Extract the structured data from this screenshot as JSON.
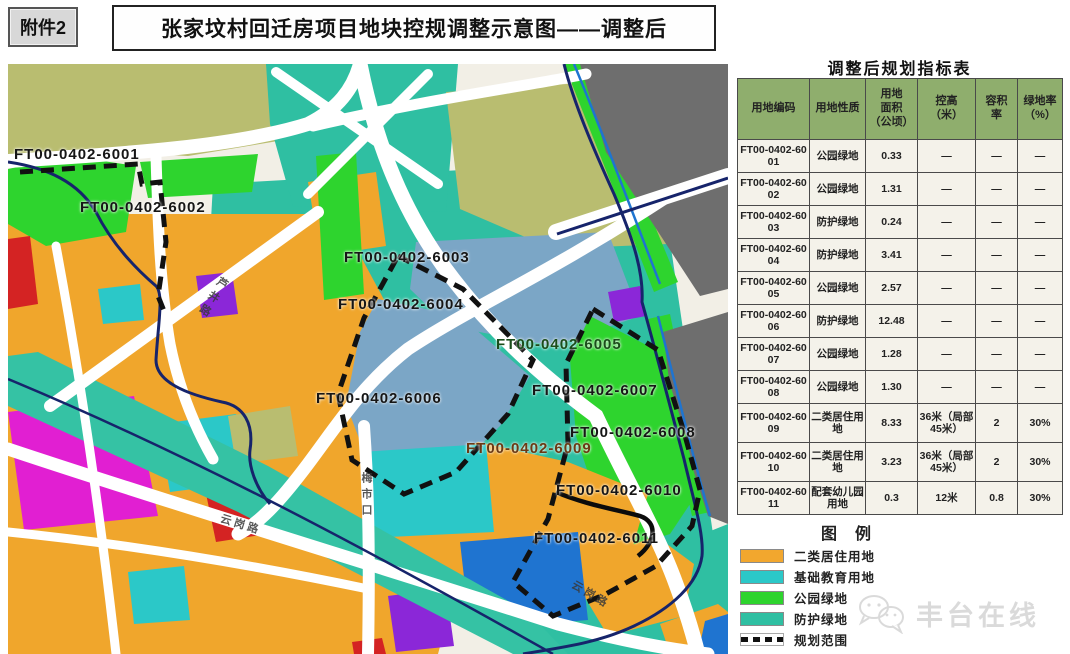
{
  "header": {
    "attachment_label": "附件2",
    "title": "张家坟村回迁房项目地块控规调整示意图——调整后"
  },
  "table": {
    "title": "调整后规划指标表",
    "columns": [
      "用地编码",
      "用地性质",
      "用地\n面积\n（公顷）",
      "控高\n（米）",
      "容积\n率",
      "绿地率\n（%）"
    ],
    "rows": [
      {
        "code": "FT00-0402-6001",
        "use": "公园绿地",
        "area": "0.33",
        "height": "—",
        "far": "—",
        "green": "—"
      },
      {
        "code": "FT00-0402-6002",
        "use": "公园绿地",
        "area": "1.31",
        "height": "—",
        "far": "—",
        "green": "—"
      },
      {
        "code": "FT00-0402-6003",
        "use": "防护绿地",
        "area": "0.24",
        "height": "—",
        "far": "—",
        "green": "—"
      },
      {
        "code": "FT00-0402-6004",
        "use": "防护绿地",
        "area": "3.41",
        "height": "—",
        "far": "—",
        "green": "—"
      },
      {
        "code": "FT00-0402-6005",
        "use": "公园绿地",
        "area": "2.57",
        "height": "—",
        "far": "—",
        "green": "—"
      },
      {
        "code": "FT00-0402-6006",
        "use": "防护绿地",
        "area": "12.48",
        "height": "—",
        "far": "—",
        "green": "—"
      },
      {
        "code": "FT00-0402-6007",
        "use": "公园绿地",
        "area": "1.28",
        "height": "—",
        "far": "—",
        "green": "—"
      },
      {
        "code": "FT00-0402-6008",
        "use": "公园绿地",
        "area": "1.30",
        "height": "—",
        "far": "—",
        "green": "—"
      },
      {
        "code": "FT00-0402-6009",
        "use": "二类居住用地",
        "area": "8.33",
        "height": "36米（局部45米）",
        "far": "2",
        "green": "30%"
      },
      {
        "code": "FT00-0402-6010",
        "use": "二类居住用地",
        "area": "3.23",
        "height": "36米（局部45米）",
        "far": "2",
        "green": "30%"
      },
      {
        "code": "FT00-0402-6011",
        "use": "配套幼儿园用地",
        "area": "0.3",
        "height": "12米",
        "far": "0.8",
        "green": "30%"
      }
    ]
  },
  "legend": {
    "title": "图例",
    "items": [
      {
        "label": "二类居住用地",
        "type": "swatch",
        "color": "#f2a72e"
      },
      {
        "label": "基础教育用地",
        "type": "swatch",
        "color": "#2bc8c8"
      },
      {
        "label": "公园绿地",
        "type": "swatch",
        "color": "#2ed42e"
      },
      {
        "label": "防护绿地",
        "type": "swatch",
        "color": "#2fbfa2"
      },
      {
        "label": "规划范围",
        "type": "dashed-line",
        "color": "#111111"
      },
      {
        "label": "村界",
        "type": "solid-line",
        "color": "#16246b"
      }
    ]
  },
  "map": {
    "plot_labels": [
      "FT00-0402-6001",
      "FT00-0402-6002",
      "FT00-0402-6003",
      "FT00-0402-6004",
      "FT00-0402-6005",
      "FT00-0402-6006",
      "FT00-0402-6007",
      "FT00-0402-6008",
      "FT00-0402-6009",
      "FT00-0402-6010",
      "FT00-0402-6011"
    ],
    "road_labels": [
      "芦井路",
      "梅市口",
      "云岗路",
      "云岗路"
    ]
  },
  "watermark": {
    "text": "丰台在线"
  },
  "colors": {
    "residential_orange": "#f2a72e",
    "education_cyan": "#2bc8c8",
    "park_green": "#2ed42e",
    "buffer_teal": "#2fbfa2",
    "olive_area": "#b9bd70",
    "built_gray": "#6e6e6e",
    "water_steelblue": "#7ba6c6",
    "village_boundary_navy": "#16246b",
    "planning_boundary_black": "#111111",
    "magenta_patch": "#e11fd2",
    "purple_patch": "#8b27d8",
    "red_patch": "#d42323",
    "blue_patch": "#1f74d0"
  }
}
